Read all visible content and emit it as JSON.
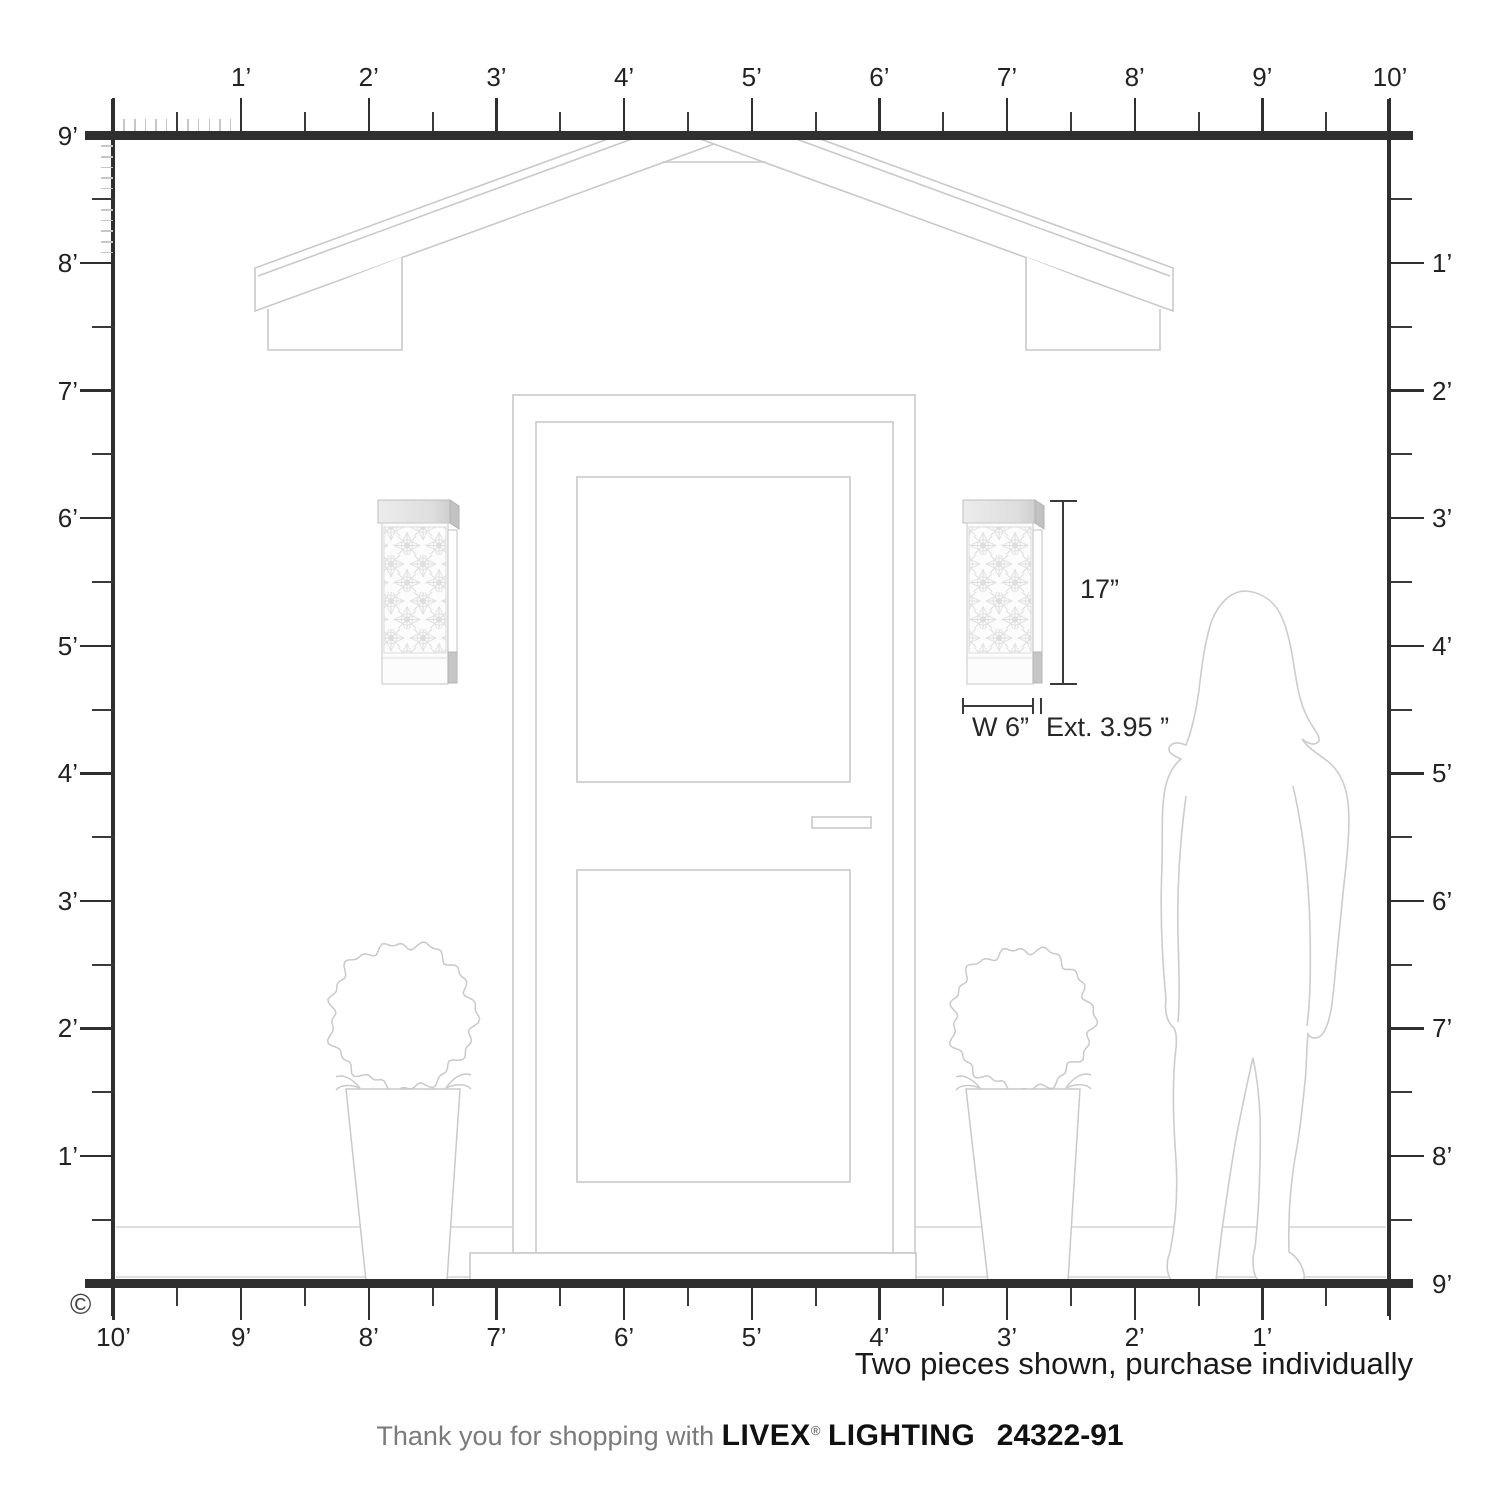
{
  "rulers": {
    "unit": "feet",
    "top_labels": [
      "1’",
      "2’",
      "3’",
      "4’",
      "5’",
      "6’",
      "7’",
      "8’",
      "9’",
      "10’"
    ],
    "left_labels": [
      "9’",
      "8’",
      "7’",
      "6’",
      "5’",
      "4’",
      "3’",
      "2’",
      "1’"
    ],
    "right_labels": [
      "1’",
      "2’",
      "3’",
      "4’",
      "5’",
      "6’",
      "7’",
      "8’",
      "9’"
    ],
    "bottom_labels": [
      "10’",
      "9’",
      "8’",
      "7’",
      "6’",
      "5’",
      "4’",
      "3’",
      "2’",
      "1’"
    ]
  },
  "dimensions": {
    "height": "17”",
    "width": "W 6”",
    "extension": "Ext. 3.95 ”"
  },
  "note": "Two pieces shown, purchase individually",
  "copyright": "©",
  "footer": {
    "thanks": "Thank you for shopping with",
    "brand": "LIVEX",
    "registered": "®",
    "brand2": "LIGHTING",
    "sku": "24322-91"
  },
  "colors": {
    "ruler": "#2f2f2f",
    "artwork_line": "#c9c9c9",
    "text": "#1a1a1a",
    "muted_text": "#7a7a7a"
  },
  "scene": {
    "items": [
      "gable-roof",
      "entry-door",
      "door-step",
      "topiary-planter-left",
      "topiary-planter-right",
      "woman-silhouette",
      "wall-sconce-left",
      "wall-sconce-right"
    ]
  }
}
